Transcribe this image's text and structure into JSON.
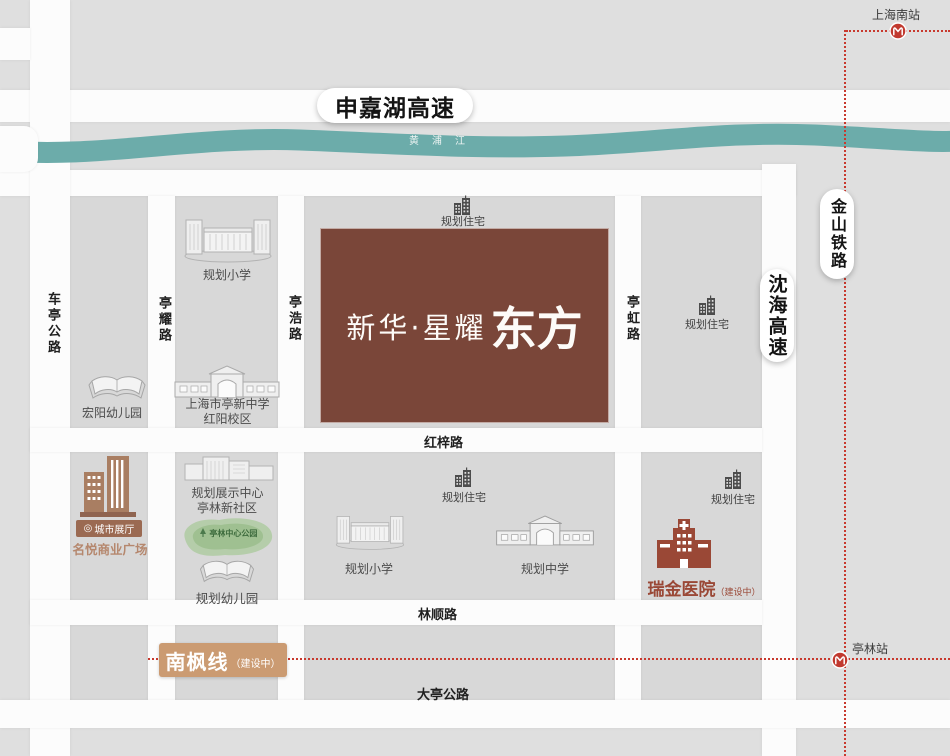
{
  "colors": {
    "map_background": "#dfdfdf",
    "city_block": "#d8d8d8",
    "road_white": "#fcfcfc",
    "river_teal": "#6cacaa",
    "project_brown": "#7a4639",
    "railway_red": "#c8392e",
    "metro_red": "#c1392f",
    "hospital_red": "#9a4836",
    "commercial_brown": "#a97e62",
    "badge_brown": "#9b6a52",
    "banner_tan": "#cb9b72",
    "park_green": "#9fc091"
  },
  "icons": {
    "pin": "◎"
  },
  "stations": {
    "shanghai_south": "上海南站",
    "tinglin": "亭林站"
  },
  "expressways": {
    "shenjiahu": "申嘉湖高速",
    "shenhai": "沈海高速"
  },
  "railway": {
    "jinshan": "金山铁路"
  },
  "river": {
    "name": "黄浦江"
  },
  "roads": {
    "cheting": "车亭公路",
    "tingyao": "亭耀路",
    "tinghao": "亭浩路",
    "tinghong": "亭虹路",
    "hongzi": "红梓路",
    "linshun": "林顺路",
    "dating": "大亭公路"
  },
  "metro_line": {
    "name": "南枫线",
    "status": "（建设中）"
  },
  "project": {
    "brand": "新华·星耀",
    "name": "东方"
  },
  "pois": {
    "planned_residential": "规划住宅",
    "planned_primary_school": "规划小学",
    "planned_middle_school": "规划中学",
    "planned_kindergarten": "规划幼儿园",
    "hongyang_kindergarten": "宏阳幼儿园",
    "tingxin_middle_school_line1": "上海市亭新中学",
    "tingxin_middle_school_line2": "红阳校区",
    "exhibition_center_line1": "规划展示中心",
    "exhibition_center_line2": "亭林新社区",
    "central_park": "亭林中心公园",
    "city_showroom": "城市展厅",
    "mingyue_plaza": "名悦商业广场",
    "ruijin_hospital": "瑞金医院",
    "ruijin_status": "（建设中）"
  }
}
